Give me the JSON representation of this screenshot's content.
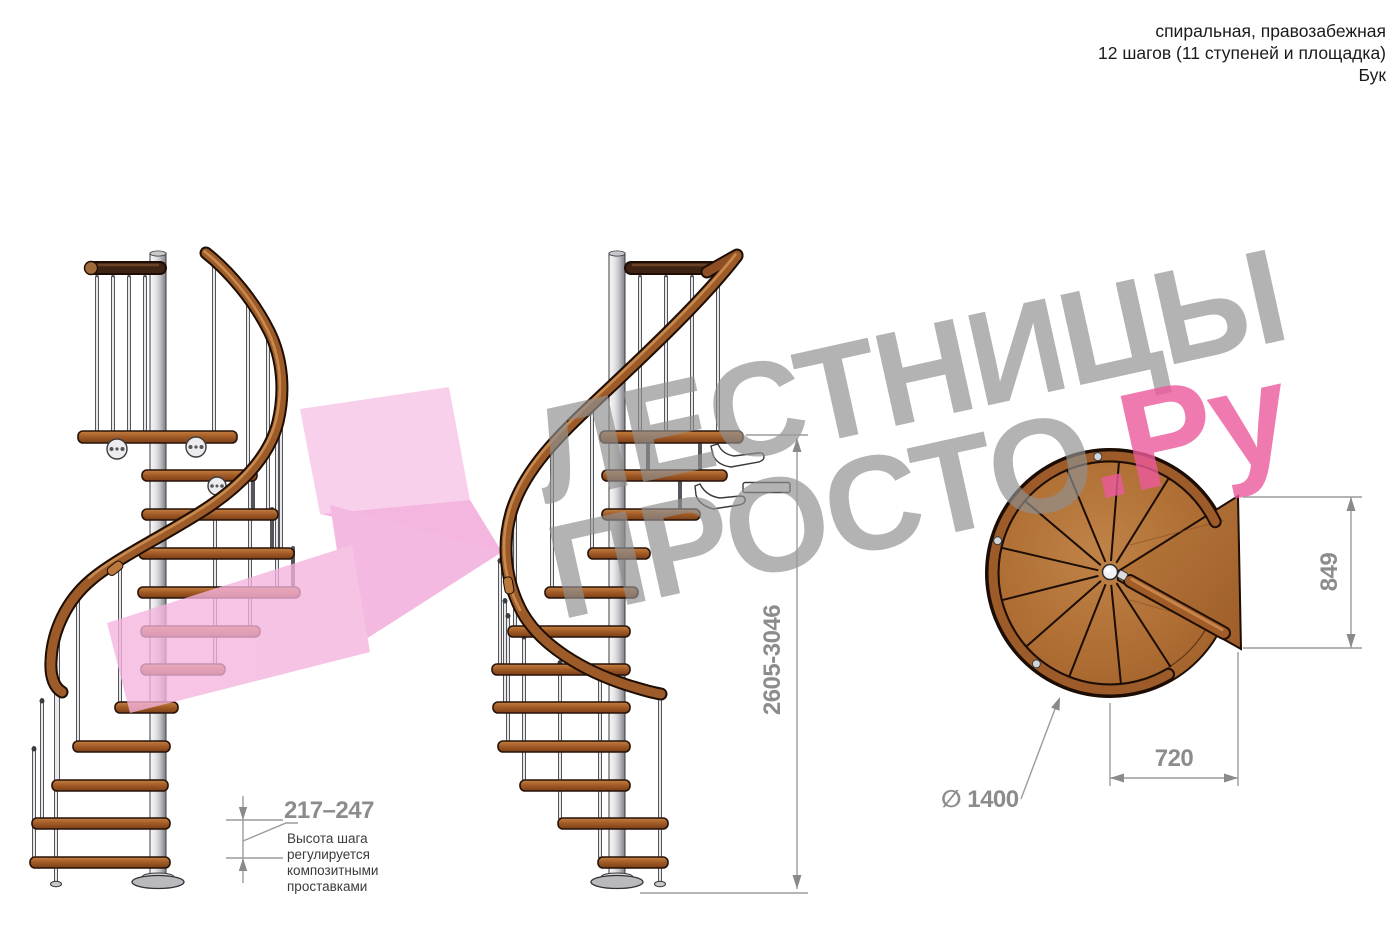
{
  "header": {
    "line1": "спиральная, правозабежная",
    "line2": "12 шагов (11 ступеней и площадка)",
    "line3": "Бук"
  },
  "watermark": {
    "word_top": "ЛЕСТНИЦЫ",
    "word_bottom": "ПРОСТО",
    "word_ru": ".Ру"
  },
  "dimensions": {
    "step_height": {
      "value": "217–247",
      "note_lines": [
        "Высота шага",
        "регулируется",
        "композитными",
        "проставками"
      ]
    },
    "total_height": "2605-3046",
    "plan_depth": "849",
    "plan_width": "720",
    "diameter": "∅ 1400"
  },
  "colors": {
    "wood": "#a9612b",
    "handrail": "#9c5b28",
    "metal_pole": "#d9dadd",
    "dimension_gray": "#8c8c8c",
    "watermark_gray": "#909090",
    "watermark_pink": "#ec5a9c",
    "arrow_pink": "#f3aedd"
  }
}
